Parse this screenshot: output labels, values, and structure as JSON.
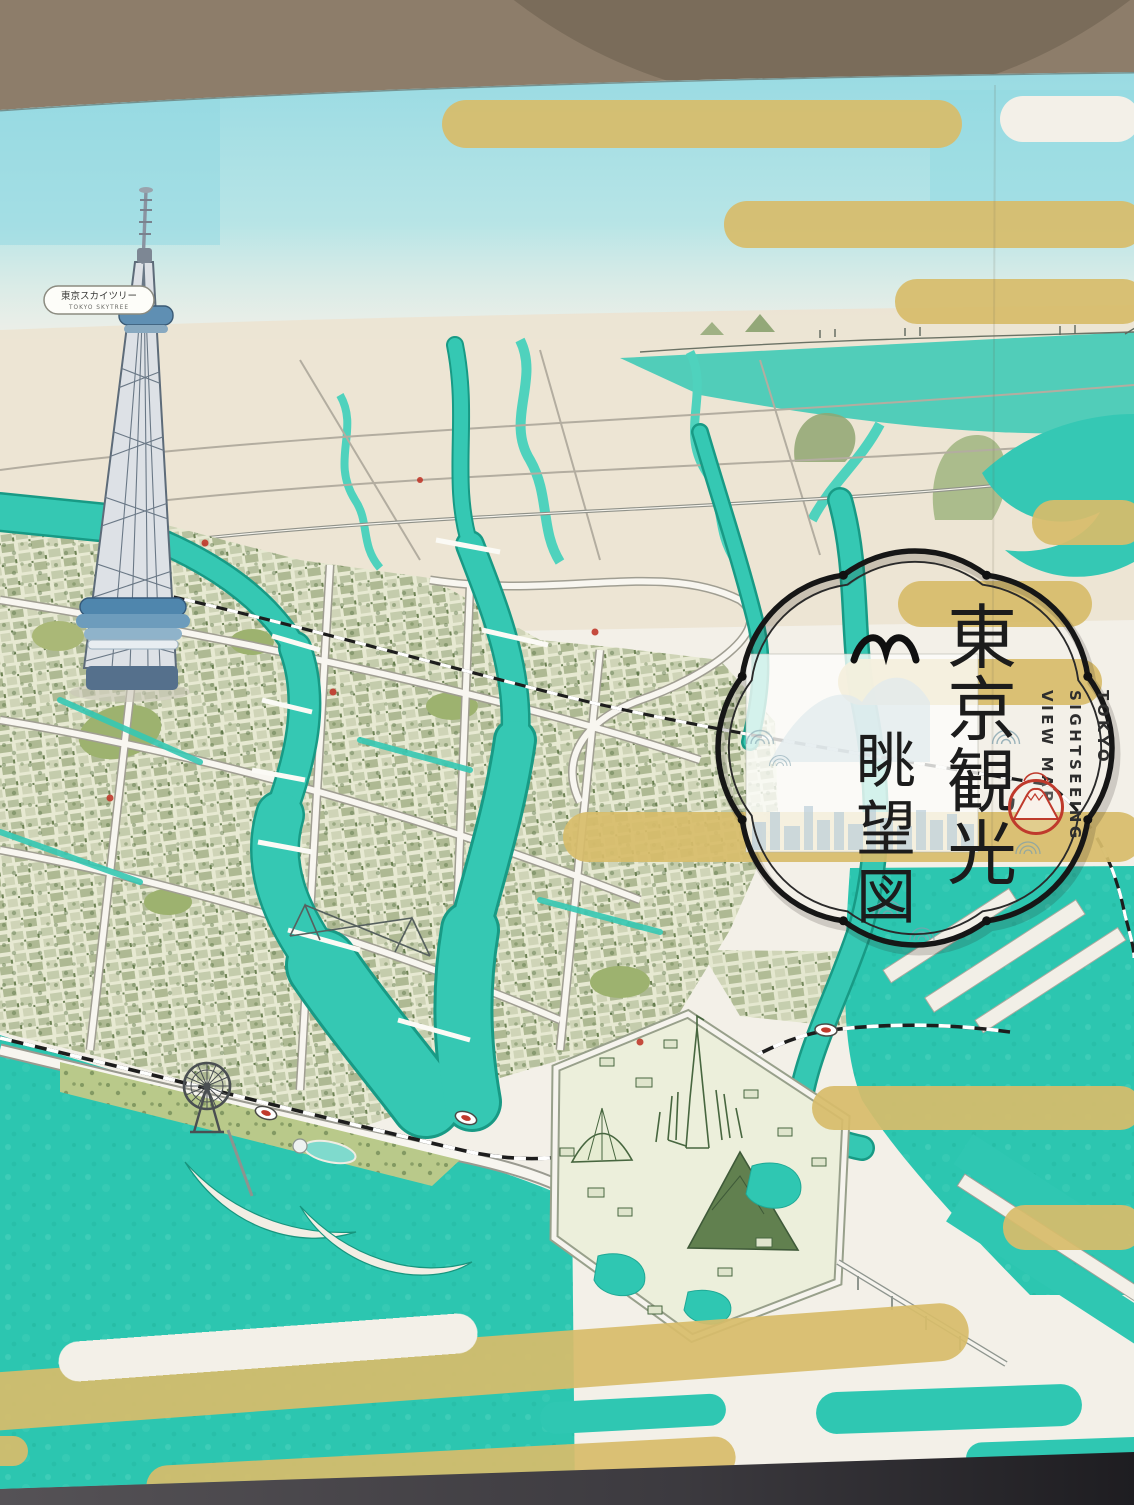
{
  "photo": {
    "wall_color": "#8d7d6a",
    "wall_arch_color": "#7a6c5a",
    "floor_color": "#46444a"
  },
  "map": {
    "palette": {
      "paper": "#f3f0e8",
      "sky": "#9edde4",
      "water_teal": "#2fc7b2",
      "water_deep": "#1a9c88",
      "gold_band": "#d8bd6b",
      "city_green": "#9fae77",
      "park_ink": "#47663f",
      "road_white": "#f8f6f0",
      "outline_ink": "#1a1a1a",
      "seal_red": "#c03a2c"
    },
    "skytree": {
      "label_jp": "東京スカイツリー",
      "label_en": "TOKYO SKYTREE"
    },
    "cartouche": {
      "title_jp": "東京観光眺望図",
      "title_col1": [
        "東",
        "京",
        "観",
        "光"
      ],
      "title_col2": [
        "眺",
        "望",
        "図"
      ],
      "subtitle_lines": [
        "TOKYO",
        "SIGHTSEEING",
        "VIEW MAP"
      ],
      "seal": "mount-fuji-red-seal",
      "mark": "bird-mark"
    },
    "landmarks": [
      "tokyo-skytree",
      "ferris-wheel",
      "theme-park",
      "tokyo-bay"
    ],
    "decor": [
      "gold-bands",
      "teal-wave-bands",
      "seigaiha-wave-stamps"
    ]
  }
}
